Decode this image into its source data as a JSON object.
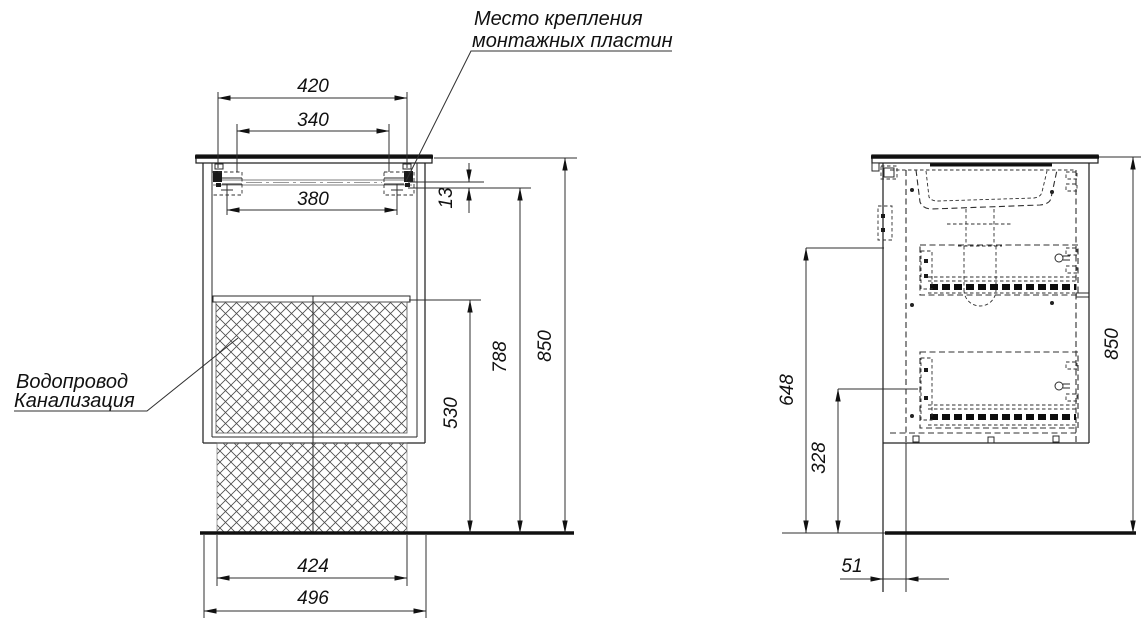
{
  "document": {
    "type": "furniture installation drawing",
    "background": "#ffffff",
    "line_color": "#1a1a1a"
  },
  "annotations": {
    "mounting": {
      "line1": "Место крепления",
      "line2": "монтажных пластин"
    },
    "plumbing": {
      "line1": "Водопровод",
      "line2": "Канализация"
    }
  },
  "front_view": {
    "dimensions": {
      "plate_span": "420",
      "inner_span": "340",
      "hole_span": "380",
      "rail_offset": "13",
      "hatch_height": "530",
      "rail_height": "788",
      "overall_height": "850",
      "hatch_width": "424",
      "cabinet_width": "496"
    }
  },
  "side_view": {
    "dimensions": {
      "drawer_top_height": "648",
      "lower_drawer_height": "328",
      "overall_height": "850",
      "wall_gap": "51"
    }
  }
}
